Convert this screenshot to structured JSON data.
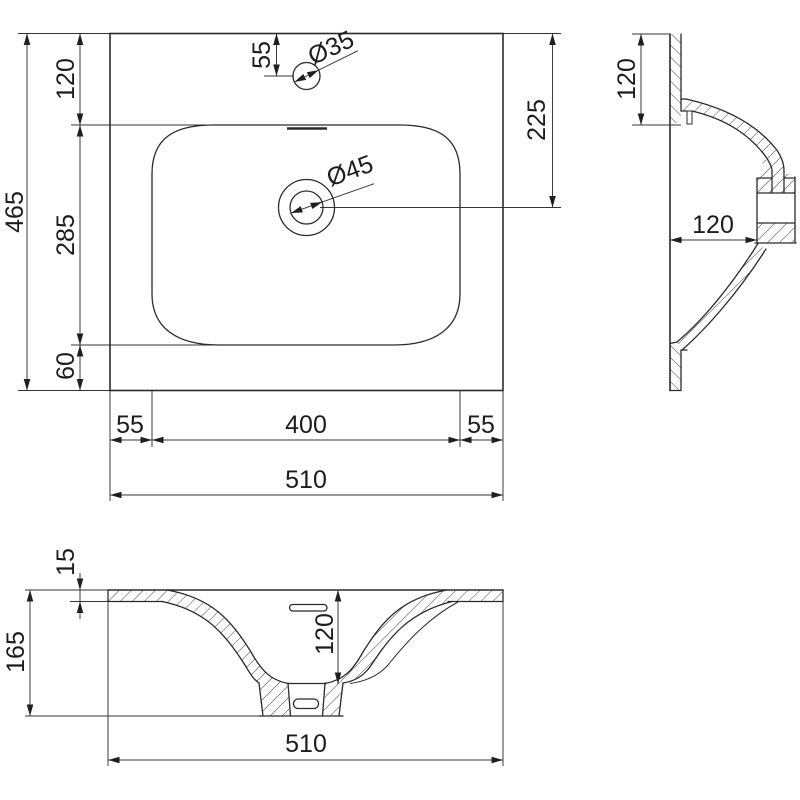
{
  "title": "Washbasin dimensional drawing",
  "colors": {
    "line": "#2b2b2b",
    "dimension": "#343434",
    "background": "#ffffff"
  },
  "views": {
    "plan": {
      "label": "plan view",
      "dims": {
        "overall_depth": "465",
        "back_strip": "120",
        "bowl_length": "285",
        "front_strip": "60",
        "faucet_from_back": "55",
        "faucet_hole_dia": "Ø35",
        "drain_from_back": "225",
        "bowl_left_margin": "55",
        "bowl_width": "400",
        "bowl_right_margin": "55",
        "overall_width": "510",
        "drain_hole_dia": "Ø45"
      }
    },
    "side": {
      "label": "side section",
      "dims": {
        "back_ledge": "120",
        "outlet_offset": "120"
      }
    },
    "front": {
      "label": "front section",
      "dims": {
        "rim_thickness": "15",
        "overall_height": "165",
        "bowl_depth": "120",
        "overall_width": "510"
      }
    }
  }
}
